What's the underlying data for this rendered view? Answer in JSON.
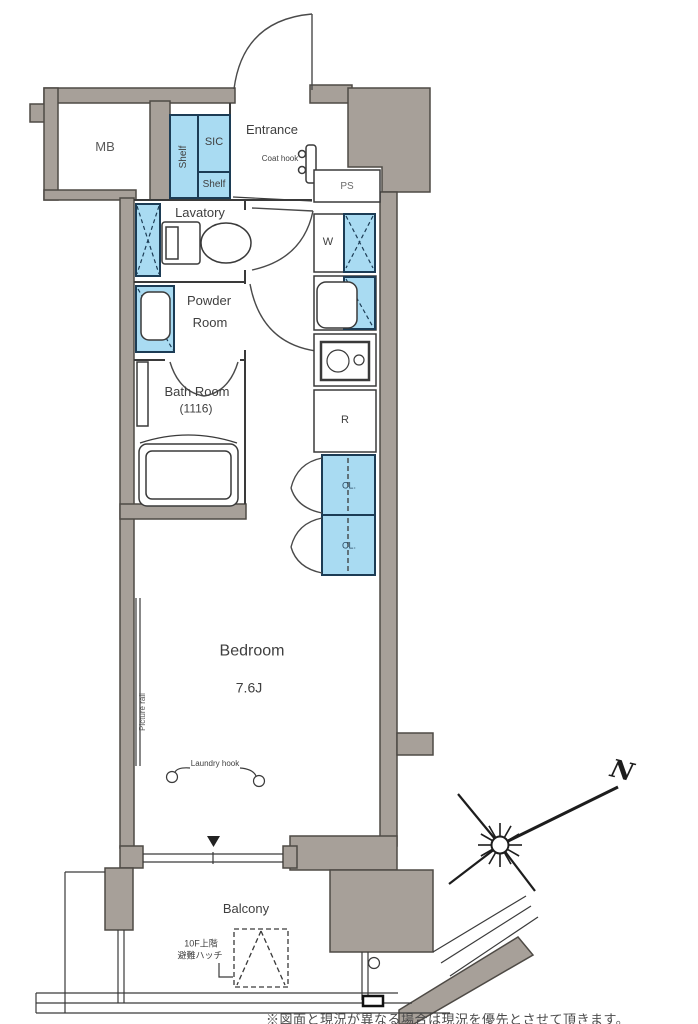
{
  "colors": {
    "wall": "#a7a099",
    "wall_stroke": "#4e4a45",
    "fixture_blue": "#a9dbf2",
    "fixture_blue_stroke": "#1c3c55",
    "line": "#3a3a3a"
  },
  "labels": {
    "mb": "MB",
    "shelf_side": "Shelf",
    "sic": "SIC",
    "shelf_bottom": "Shelf",
    "entrance": "Entrance",
    "coat_hook": "Coat hook",
    "ps": "PS",
    "washer": "W",
    "lavatory": "Lavatory",
    "powder_line1": "Powder",
    "powder_line2": "Room",
    "bath_line1": "Bath Room",
    "bath_line2": "(1116)",
    "fridge": "R",
    "closet_upper": "CL.",
    "closet_lower": "CL.",
    "bedroom": "Bedroom",
    "bedroom_size": "7.6J",
    "picture_rail": "Picture rail",
    "laundry_hook": "Laundry hook",
    "balcony": "Balcony",
    "hatch_line1": "10F上階",
    "hatch_line2": "避難ハッチ",
    "north": "N",
    "bottom_note": "※図面と現況が異なる場合は現況を優先とさせて頂きます。"
  }
}
